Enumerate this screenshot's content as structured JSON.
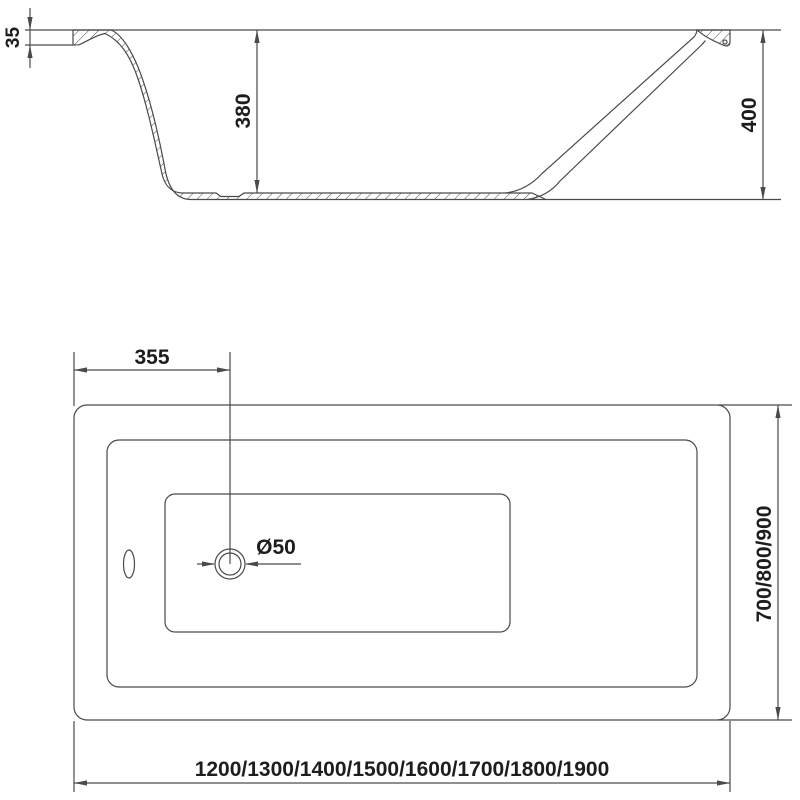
{
  "colors": {
    "line": "#4a4a4a",
    "text": "#1d1d1d",
    "background": "#ffffff"
  },
  "side_view": {
    "dim_rim_thickness": "35",
    "dim_inner_depth": "380",
    "dim_total_height": "400"
  },
  "plan_view": {
    "dim_drain_offset": "355",
    "dim_drain_diameter": "Ø50",
    "dim_width_options": "700/800/900",
    "dim_length_options": "1200/1300/1400/1500/1600/1700/1800/1900"
  }
}
